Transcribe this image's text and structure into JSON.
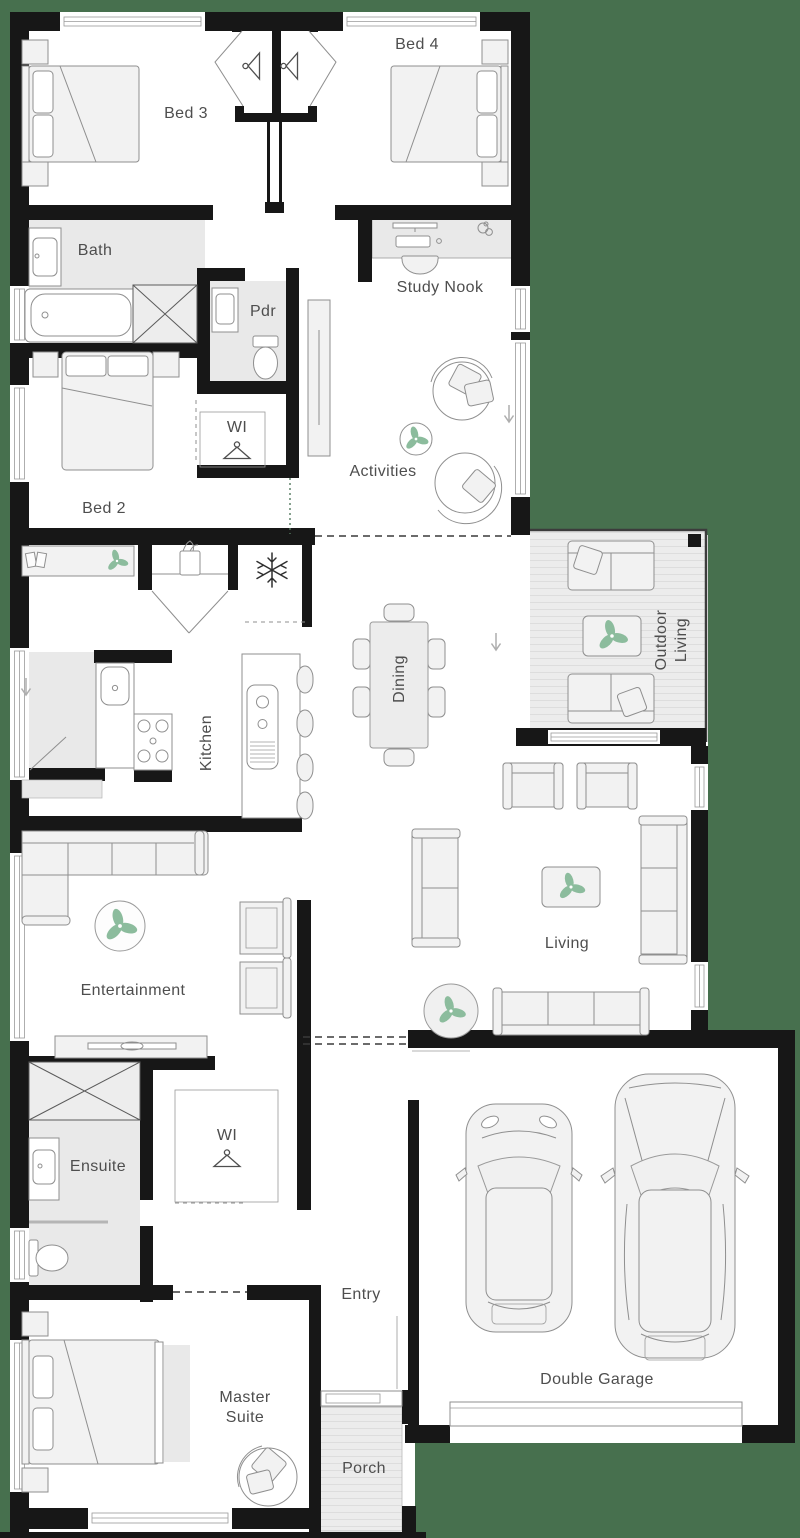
{
  "rooms": {
    "bed3": {
      "label": "Bed 3"
    },
    "bed4": {
      "label": "Bed 4"
    },
    "bath": {
      "label": "Bath"
    },
    "pdr": {
      "label": "Pdr"
    },
    "study_nook": {
      "label": "Study Nook"
    },
    "wi_upper": {
      "label": "WI"
    },
    "bed2": {
      "label": "Bed 2"
    },
    "activities": {
      "label": "Activities"
    },
    "outdoor_living": {
      "label": "Outdoor Living"
    },
    "dining": {
      "label": "Dining"
    },
    "kitchen": {
      "label": "Kitchen"
    },
    "entertainment": {
      "label": "Entertainment"
    },
    "living": {
      "label": "Living"
    },
    "ensuite": {
      "label": "Ensuite"
    },
    "wi_lower": {
      "label": "WI"
    },
    "entry": {
      "label": "Entry"
    },
    "master_suite": {
      "label": "Master Suite"
    },
    "double_garage": {
      "label": "Double Garage"
    },
    "porch": {
      "label": "Porch"
    }
  },
  "icons": {
    "wardrobe": "hanger-icon",
    "fridge_space": "snowflake-icon",
    "decor": "plant-icon",
    "entry_direction": "arrow-down-icon",
    "console_book": "book-icon"
  },
  "colors": {
    "background": "#47704e",
    "walls": "#171717",
    "wet_area_fill": "#e9e9e9",
    "deck_fill": "#ececec",
    "furniture_outline": "#8f8f8f",
    "plant_green": "#8cbc9d",
    "label_text": "#4e4e4e"
  }
}
